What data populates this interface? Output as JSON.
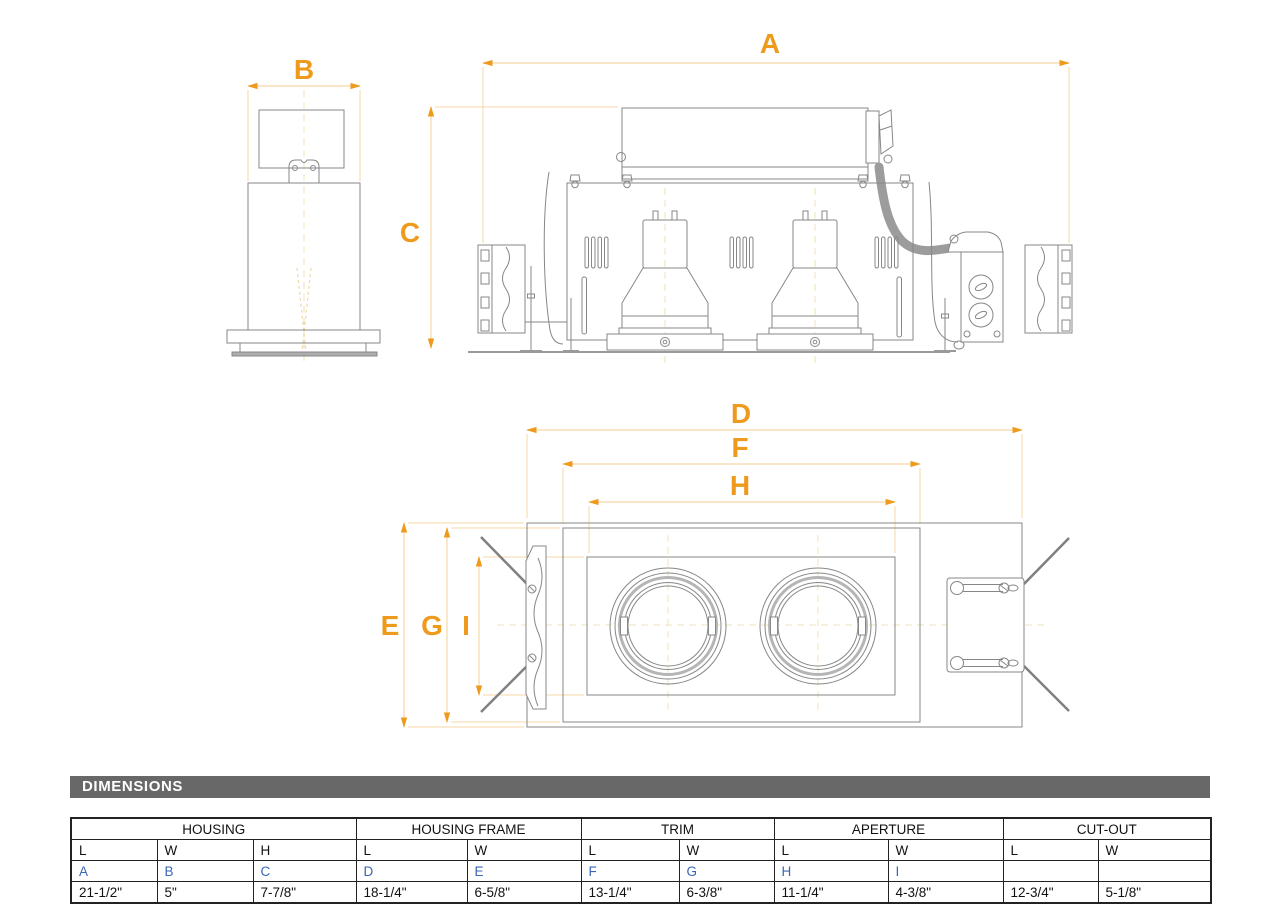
{
  "title_bar": {
    "label": "DIMENSIONS"
  },
  "dim_labels": {
    "a": "A",
    "b": "B",
    "c": "C",
    "d": "D",
    "e": "E",
    "f": "F",
    "g": "G",
    "h": "H",
    "i": "I"
  },
  "colors": {
    "accent_orange": "#EE9A1C",
    "dim_line": "#F5D7A4",
    "blue_letter": "#3A66B5",
    "line_gray": "#878787",
    "bar_gray": "#686868",
    "centerline": "#EFE3BC"
  },
  "table": {
    "groups": [
      {
        "label": "HOUSING",
        "columns": [
          "L",
          "W",
          "H"
        ],
        "letters": [
          "A",
          "B",
          "C"
        ],
        "values": [
          "21-1/2\"",
          "5\"",
          "7-7/8\""
        ]
      },
      {
        "label": "HOUSING FRAME",
        "columns": [
          "L",
          "W"
        ],
        "letters": [
          "D",
          "E"
        ],
        "values": [
          "18-1/4\"",
          "6-5/8\""
        ]
      },
      {
        "label": "TRIM",
        "columns": [
          "L",
          "W"
        ],
        "letters": [
          "F",
          "G"
        ],
        "values": [
          "13-1/4\"",
          "6-3/8\""
        ]
      },
      {
        "label": "APERTURE",
        "columns": [
          "L",
          "W"
        ],
        "letters": [
          "H",
          "I"
        ],
        "values": [
          "11-1/4\"",
          "4-3/8\""
        ]
      },
      {
        "label": "CUT-OUT",
        "columns": [
          "L",
          "W"
        ],
        "letters": [
          "",
          ""
        ],
        "values": [
          "12-3/4\"",
          "5-1/8\""
        ]
      }
    ]
  }
}
